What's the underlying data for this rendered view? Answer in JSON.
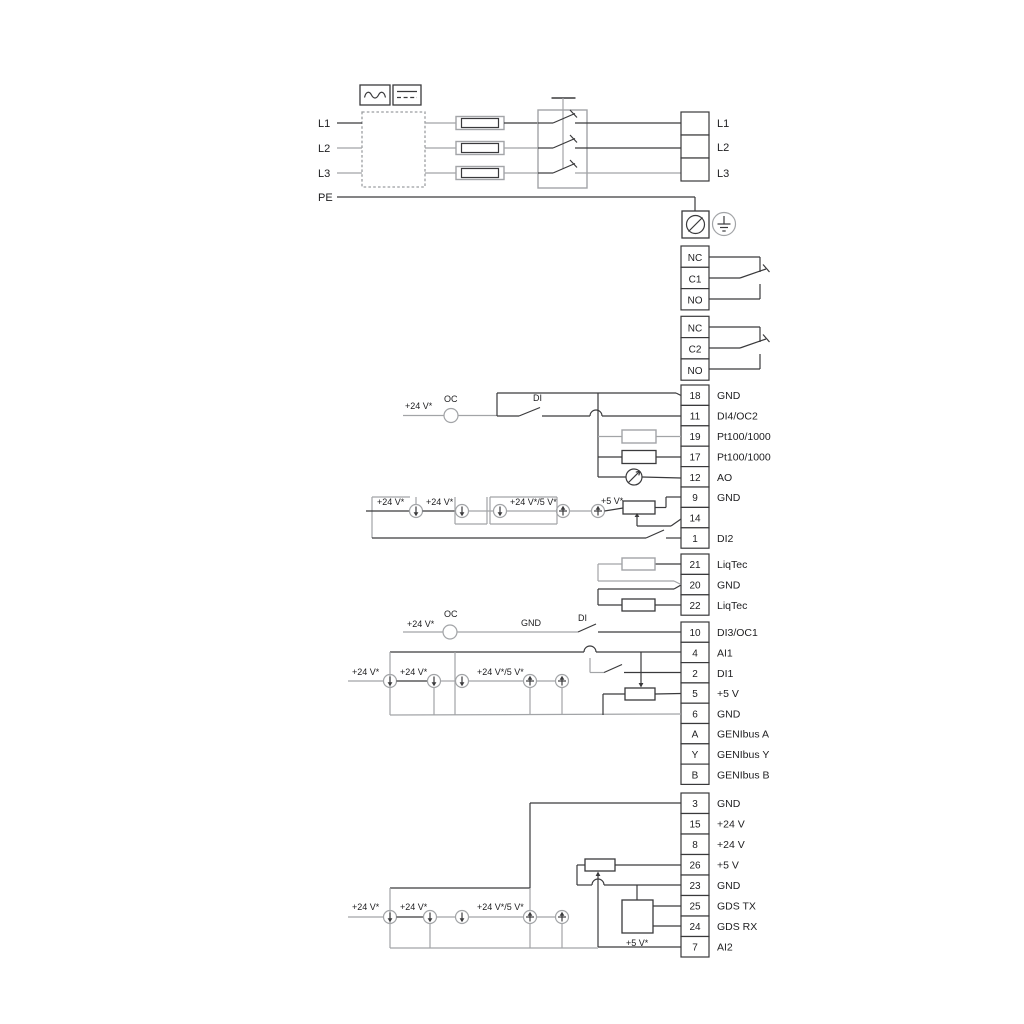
{
  "labels": {
    "plus24": "+24 V*",
    "plus24or5": "+24 V*/5 V*",
    "plus5": "+5 V*",
    "oc": "OC",
    "di": "DI",
    "gnd": "GND"
  },
  "power": {
    "in": [
      "L1",
      "L2",
      "L3",
      "PE"
    ],
    "out": [
      "L1",
      "L2",
      "L3"
    ]
  },
  "relay1": [
    "NC",
    "C1",
    "NO"
  ],
  "relay2": [
    "NC",
    "C2",
    "NO"
  ],
  "strip1": [
    {
      "n": "18",
      "l": "GND"
    },
    {
      "n": "11",
      "l": "DI4/OC2"
    },
    {
      "n": "19",
      "l": "Pt100/1000"
    },
    {
      "n": "17",
      "l": "Pt100/1000"
    },
    {
      "n": "12",
      "l": "AO"
    },
    {
      "n": "9",
      "l": "GND"
    },
    {
      "n": "14",
      "l": "AI3"
    },
    {
      "n": "1",
      "l": "DI2"
    }
  ],
  "strip2": [
    {
      "n": "21",
      "l": "LiqTec"
    },
    {
      "n": "20",
      "l": "GND"
    },
    {
      "n": "22",
      "l": "LiqTec"
    }
  ],
  "strip3": [
    {
      "n": "10",
      "l": "DI3/OC1"
    },
    {
      "n": "4",
      "l": "AI1"
    },
    {
      "n": "2",
      "l": "DI1"
    },
    {
      "n": "5",
      "l": "+5 V"
    },
    {
      "n": "6",
      "l": "GND"
    },
    {
      "n": "A",
      "l": "GENIbus A"
    },
    {
      "n": "Y",
      "l": "GENIbus Y"
    },
    {
      "n": "B",
      "l": "GENIbus B"
    }
  ],
  "strip4": [
    {
      "n": "3",
      "l": "GND"
    },
    {
      "n": "15",
      "l": "+24 V"
    },
    {
      "n": "8",
      "l": "+24 V"
    },
    {
      "n": "26",
      "l": "+5 V"
    },
    {
      "n": "23",
      "l": "GND"
    },
    {
      "n": "25",
      "l": "GDS TX"
    },
    {
      "n": "24",
      "l": "GDS RX"
    },
    {
      "n": "7",
      "l": "AI2"
    }
  ],
  "colors": {
    "wire_dark": "#3a3a3c",
    "wire_gray": "#a2a4a7",
    "text": "#1d1d1f",
    "background": "#ffffff"
  }
}
